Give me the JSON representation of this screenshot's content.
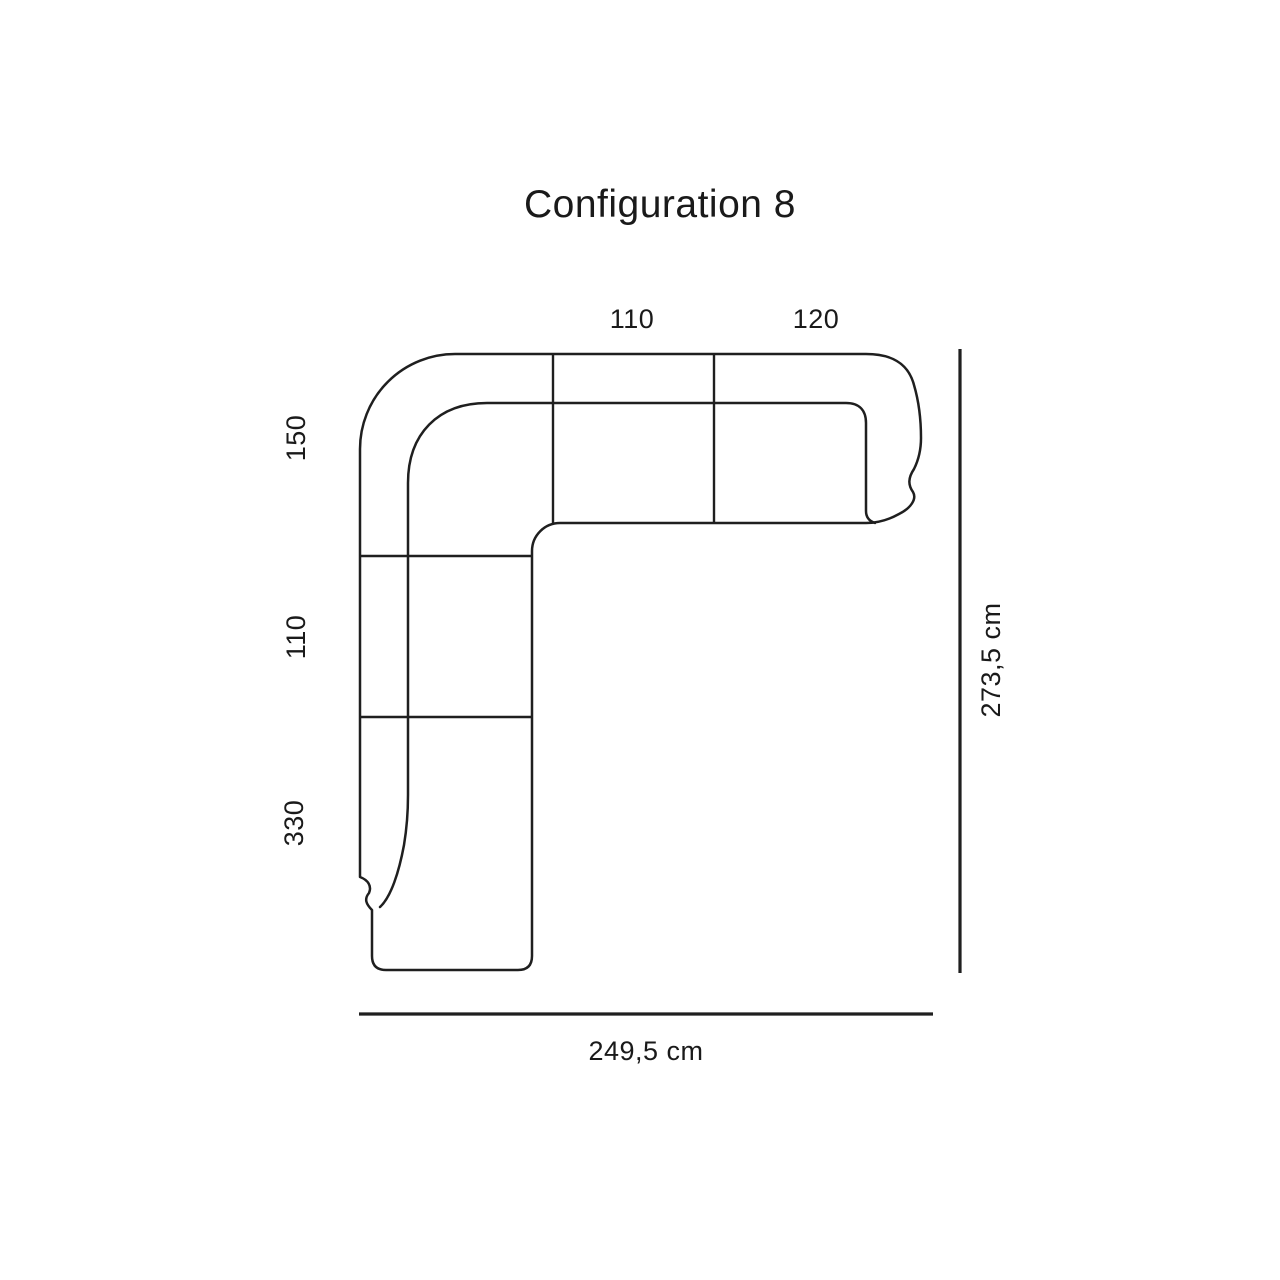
{
  "title": "Configuration 8",
  "colors": {
    "background": "#ffffff",
    "line": "#1f1f1f",
    "text": "#1a1a1a"
  },
  "diagram": {
    "type": "corner-sofa-top-view",
    "top_segment_widths": [
      "110",
      "120"
    ],
    "left_segment_heights": [
      "150",
      "110",
      "330"
    ],
    "total_width": "249,5 cm",
    "total_depth": "273,5 cm"
  }
}
